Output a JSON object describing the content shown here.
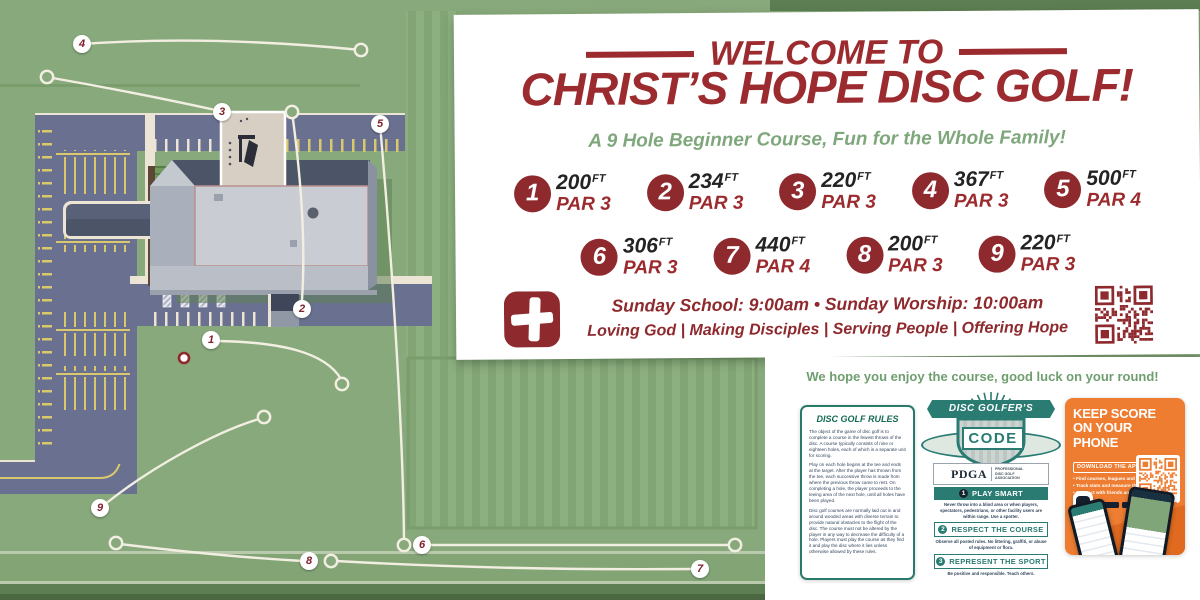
{
  "colors": {
    "brand_red": "#9b2b2e",
    "map_green": "#88a97b",
    "subtitle_green": "#7fa77c",
    "code_teal": "#2a7c72",
    "udisc_orange": "#ee7d32",
    "parking_gray": "#6a7190"
  },
  "map": {
    "markers": [
      {
        "label": "1",
        "x": 211,
        "y": 340
      },
      {
        "label": "2",
        "x": 302,
        "y": 309
      },
      {
        "label": "3",
        "x": 222,
        "y": 112
      },
      {
        "label": "4",
        "x": 82,
        "y": 44
      },
      {
        "label": "5",
        "x": 380,
        "y": 124
      },
      {
        "label": "6",
        "x": 422,
        "y": 545
      },
      {
        "label": "7",
        "x": 700,
        "y": 569
      },
      {
        "label": "8",
        "x": 309,
        "y": 561
      },
      {
        "label": "9",
        "x": 100,
        "y": 508
      }
    ]
  },
  "panel": {
    "welcome": "WELCOME TO",
    "title": "CHRIST’S HOPE DISC GOLF!",
    "subtitle": "A 9 Hole Beginner Course, Fun for the Whole Family!",
    "holes_row1": [
      {
        "n": "1",
        "dist": "200",
        "unit": "FT",
        "par": "PAR 3"
      },
      {
        "n": "2",
        "dist": "234",
        "unit": "FT",
        "par": "PAR 3"
      },
      {
        "n": "3",
        "dist": "220",
        "unit": "FT",
        "par": "PAR 3"
      },
      {
        "n": "4",
        "dist": "367",
        "unit": "FT",
        "par": "PAR 3"
      },
      {
        "n": "5",
        "dist": "500",
        "unit": "FT",
        "par": "PAR 4"
      }
    ],
    "holes_row2": [
      {
        "n": "6",
        "dist": "306",
        "unit": "FT",
        "par": "PAR 3"
      },
      {
        "n": "7",
        "dist": "440",
        "unit": "FT",
        "par": "PAR 4"
      },
      {
        "n": "8",
        "dist": "200",
        "unit": "FT",
        "par": "PAR 3"
      },
      {
        "n": "9",
        "dist": "220",
        "unit": "FT",
        "par": "PAR 3"
      }
    ],
    "schedule": {
      "l1": "Sunday School:",
      "t1": " 9:00am ",
      "sep": "•",
      "l2": " Sunday Worship:",
      "t2": " 10:00am"
    },
    "motto": "Loving God | Making Disciples | Serving People | Offering Hope"
  },
  "bottom": {
    "enjoy": "We hope you enjoy the course, good luck on your round!",
    "rules": {
      "title": "DISC GOLF RULES",
      "paragraphs": [
        "The object of the game of disc golf is to complete a course in the fewest throws of the disc. A course typically consists of nine or eighteen holes, each of which is a separate unit for scoring.",
        "Play on each hole begins at the tee and ends at the target. After the player has thrown from the tee, each successive throw is made from where the previous throw came to rest. On completing a hole, the player proceeds to the teeing area of the next hole, until all holes have been played.",
        "Disc golf courses are normally laid out in and around wooded areas with diverse terrain to provide natural obstacles to the flight of the disc. The course must not be altered by the player in any way to decrease the difficulty of a hole. Players must play the course as they find it and play the disc where it lies unless otherwise allowed by these rules."
      ]
    },
    "code": {
      "banner": "DISC GOLFER’S",
      "shield": "CODE",
      "org": "PDGA",
      "org_tag": "Professional Disc Golf Association",
      "items": [
        {
          "n": "1",
          "title": "PLAY SMART",
          "text": "Never throw into a blind area or when players, spectators, pedestrians, or other facility users are within range. Use a spotter."
        },
        {
          "n": "2",
          "title": "RESPECT THE COURSE",
          "text": "Observe all posted rules. No littering, graffiti, or abuse of equipment or flora."
        },
        {
          "n": "3",
          "title": "REPRESENT THE SPORT",
          "text": "Be positive and responsible. Teach others."
        }
      ]
    },
    "app": {
      "line1": "KEEP SCORE",
      "line2": "ON YOUR PHONE",
      "download": "DOWNLOAD THE APP",
      "bullets": [
        "• Find courses, leagues and events",
        "• Track stats and measure throws",
        "• Connect with friends and more"
      ],
      "brand": "UDisc"
    }
  }
}
